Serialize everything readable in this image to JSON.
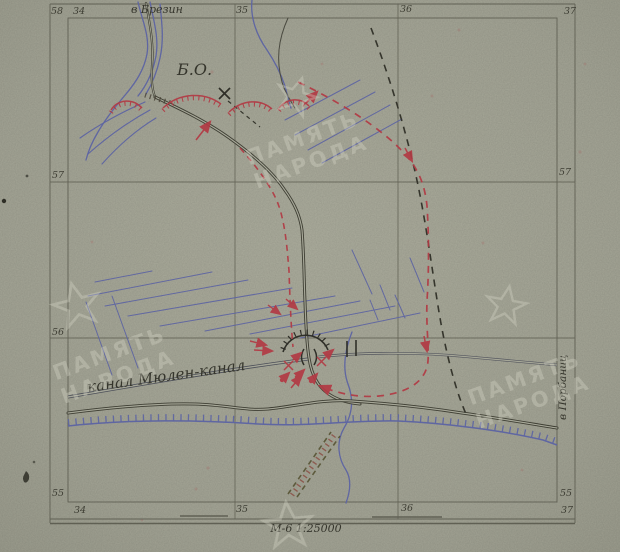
{
  "map": {
    "grid_labels": {
      "top_row": "58",
      "top_col34": "34",
      "top_dest": "в Брезин",
      "top_col35": "35",
      "top_col36": "36",
      "top_col37": "37",
      "left_57": "57",
      "left_56": "56",
      "left_55": "55",
      "right_57": "57",
      "right_55": "55",
      "bottom_34": "34",
      "bottom_35": "35",
      "bottom_36": "36",
      "bottom_37": "37"
    },
    "annotations": {
      "strongpoint": "Б.О.",
      "canal_name": "канал Мюлен-канал",
      "dest_right": "в Порбаниц",
      "scale_note": "М-6 1:25000"
    },
    "watermark": {
      "line1": "ПАМЯТЬ",
      "line2": "НАРОДА"
    },
    "colors": {
      "paper": "#a6a798",
      "ink": "#3b3b31",
      "water_blue": "#5f66a2",
      "enemy_red": "#b23a44",
      "grid_line": "#5a5a4e",
      "watermark": "#dcdccd"
    }
  }
}
